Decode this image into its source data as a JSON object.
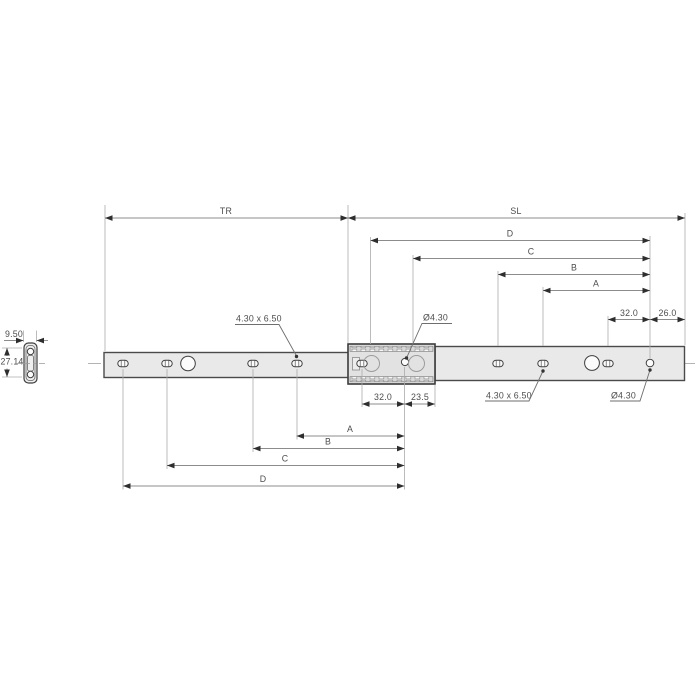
{
  "labels": {
    "tr": "TR",
    "sl": "SL",
    "top_d": "D",
    "top_c": "C",
    "top_b": "B",
    "top_a": "A",
    "top_32": "32.0",
    "top_26": "26.0",
    "bottom_32": "32.0",
    "bottom_23_5": "23.5",
    "bottom_a": "A",
    "bottom_b": "B",
    "bottom_c": "C",
    "bottom_d": "D",
    "slot_callout_left": "4.30 x 6.50",
    "hole_callout_left": "Ø4.30",
    "slot_callout_right": "4.30 x 6.50",
    "hole_callout_right": "Ø4.30",
    "section_width": "9.50",
    "section_height": "27.14"
  },
  "colors": {
    "background": "#ffffff",
    "rail_fill": "#e9e9e9",
    "rail_stroke": "#4a4a4a",
    "dimension_line": "#8c8c8c",
    "extension_line": "#ababab",
    "text": "#4d4d4d",
    "arrow": "#2e2e2e",
    "ghost_circle": "#9c9c9c"
  }
}
